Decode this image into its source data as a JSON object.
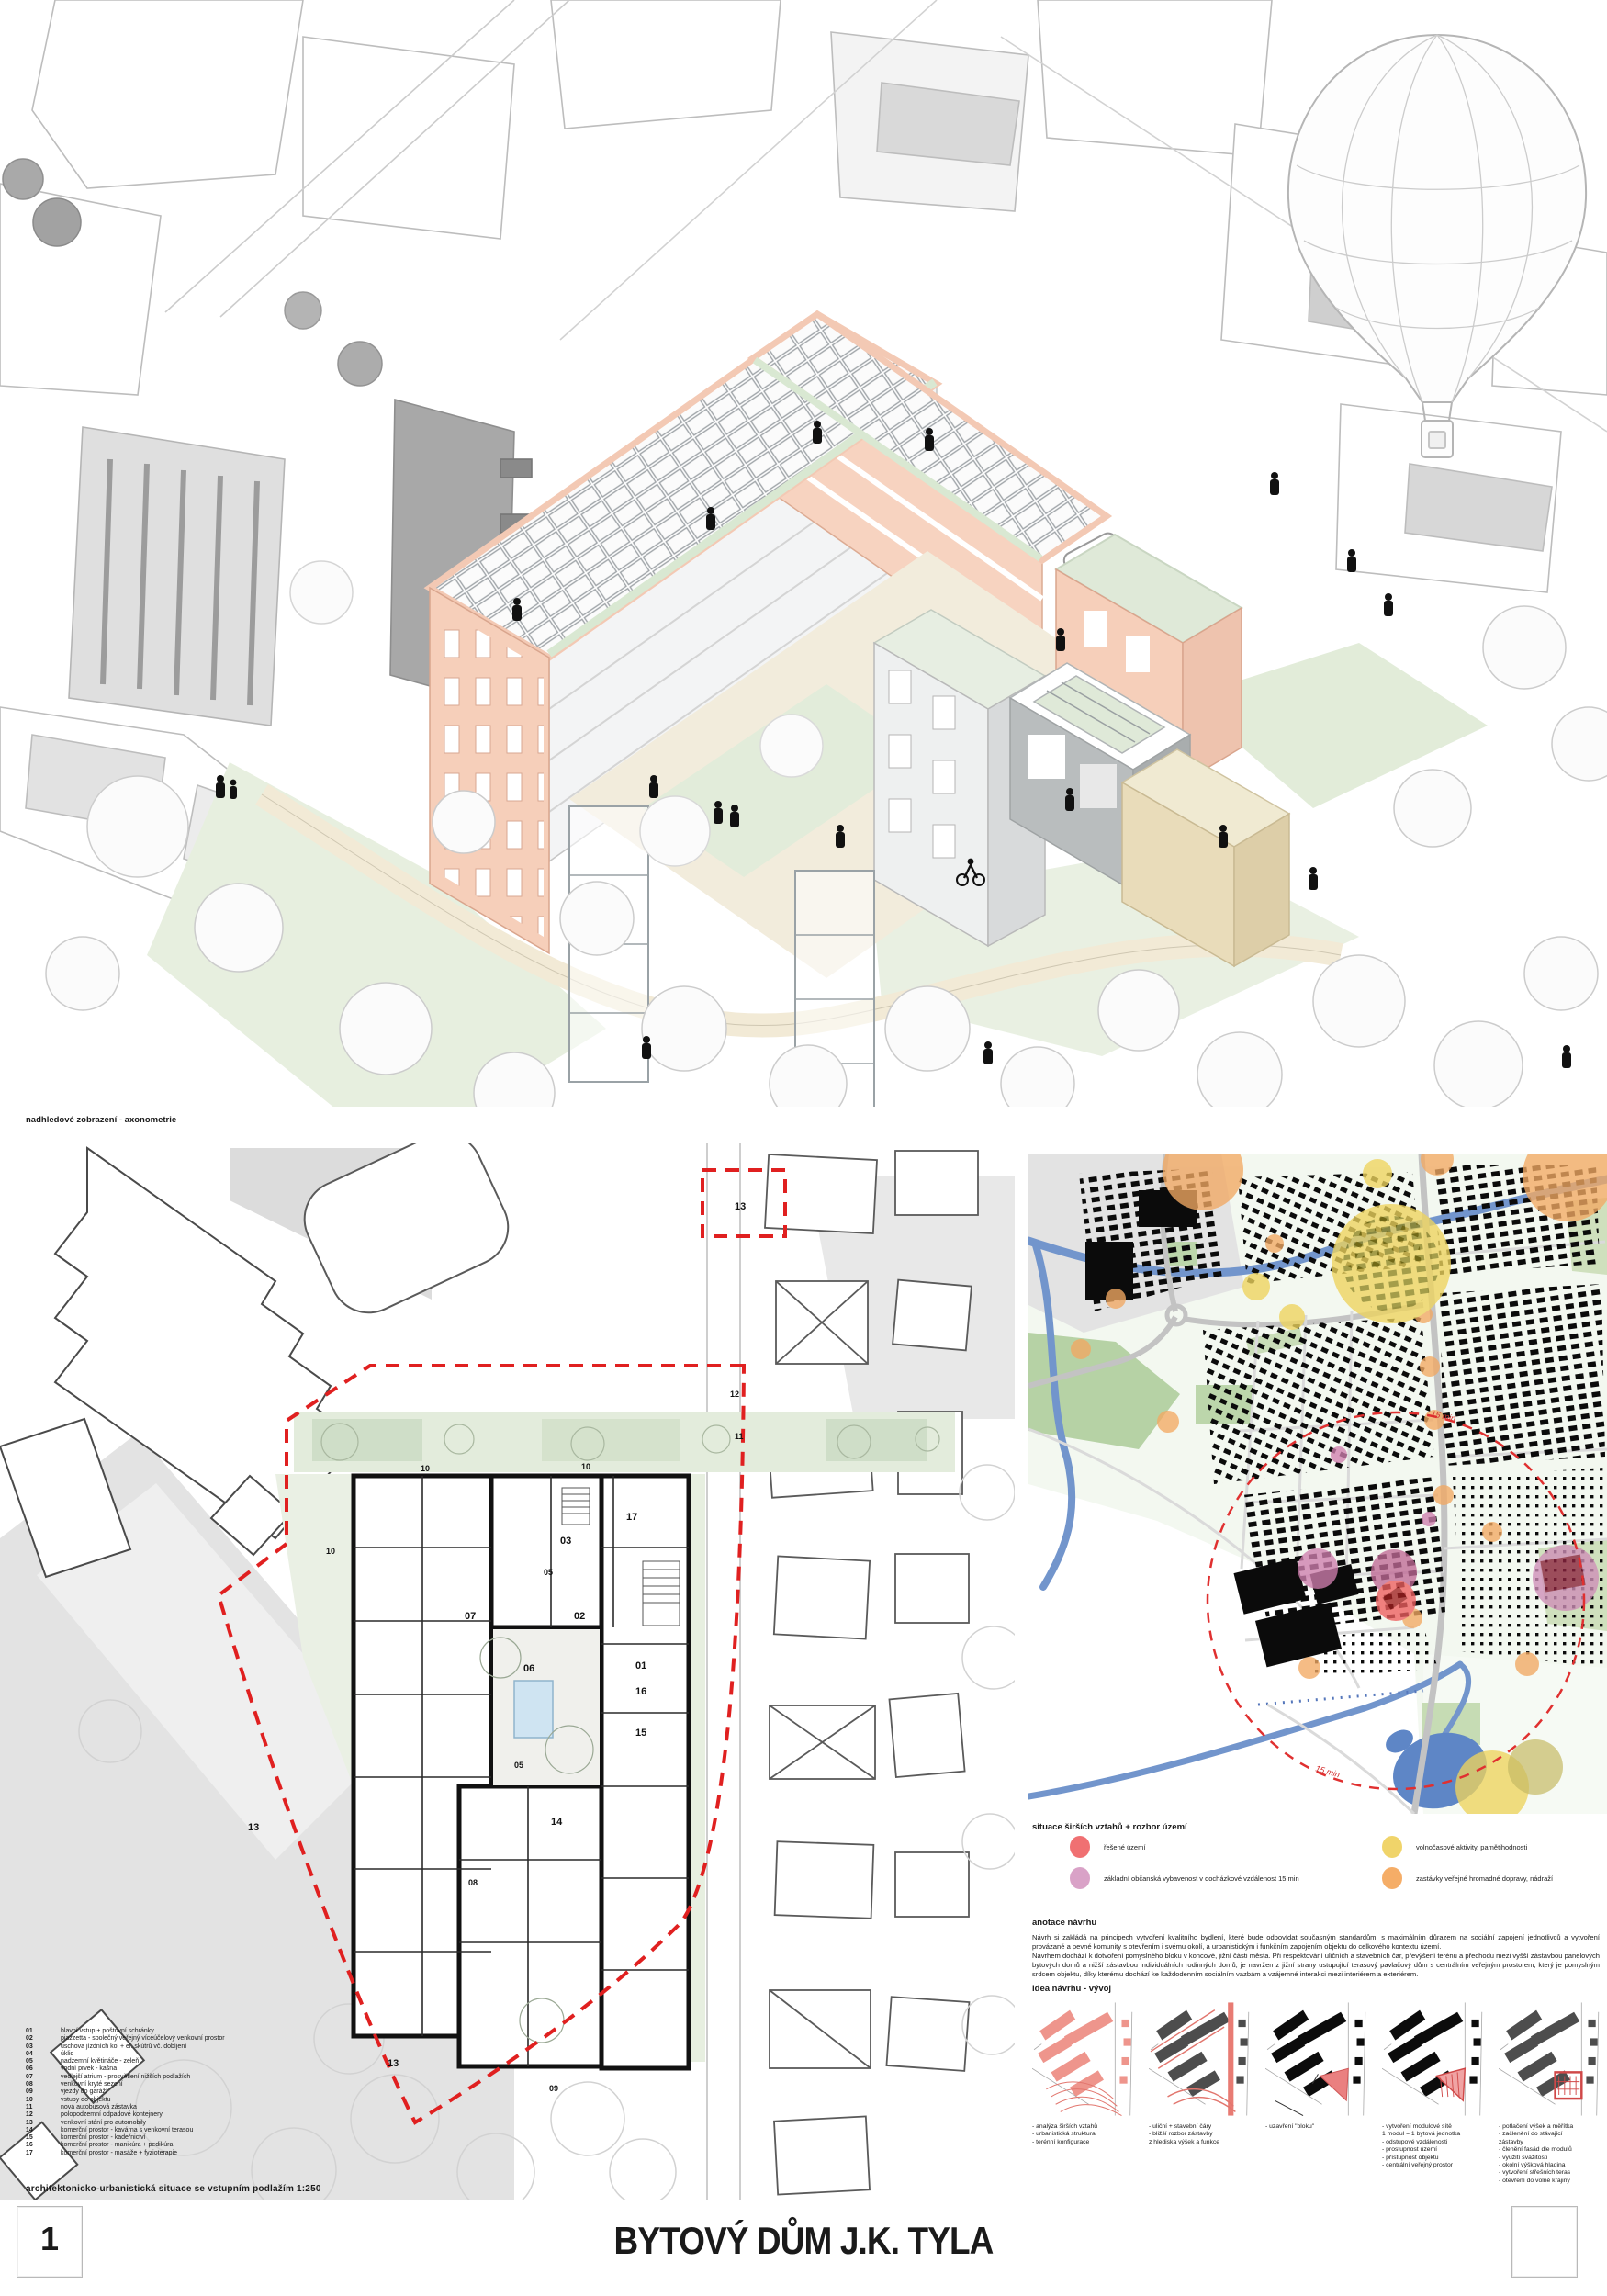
{
  "poster": {
    "sheet_number": "1",
    "title": "BYTOVÝ DŮM J.K. TYLA"
  },
  "axon": {
    "caption": "nadhledové zobrazení - axonometrie"
  },
  "site_plan": {
    "caption": "architektonicko-urbanistická situace se vstupním podlažím 1:250",
    "legend": [
      {
        "num": "01",
        "label": "hlavní vstup + poštovní schránky"
      },
      {
        "num": "02",
        "label": "piazzetta - společný veřejný víceúčelový venkovní prostor"
      },
      {
        "num": "03",
        "label": "úschova jízdních kol +  el. skútrů vč. dobíjení"
      },
      {
        "num": "04",
        "label": "úklid"
      },
      {
        "num": "05",
        "label": "nadzemní květináče - zeleň"
      },
      {
        "num": "06",
        "label": "vodní prvek - kašna"
      },
      {
        "num": "07",
        "label": "vedlejší atrium - prosvětlení nižších podlažích"
      },
      {
        "num": "08",
        "label": "venkovní kryté sezení"
      },
      {
        "num": "09",
        "label": "vjezdy do garáží"
      },
      {
        "num": "10",
        "label": "vstupy do objektu"
      },
      {
        "num": "11",
        "label": "nová autobusová zástavka"
      },
      {
        "num": "12",
        "label": "polopodzemní odpadové kontejnery"
      },
      {
        "num": "13",
        "label": "venkovní stání pro automobily"
      },
      {
        "num": "14",
        "label": "komerční prostor - kavárna s venkovní terasou"
      },
      {
        "num": "15",
        "label": "komerční prostor - kadeřnictví"
      },
      {
        "num": "16",
        "label": "komerční prostor - manikúra + pedikúra"
      },
      {
        "num": "17",
        "label": "komerční prostor - masáže + fyzioterapie"
      }
    ],
    "marks": [
      {
        "t": "13"
      },
      {
        "t": "10"
      },
      {
        "t": "10"
      },
      {
        "t": "10"
      },
      {
        "t": "03"
      },
      {
        "t": "17"
      },
      {
        "t": "05"
      },
      {
        "t": "07"
      },
      {
        "t": "06"
      },
      {
        "t": "02"
      },
      {
        "t": "01"
      },
      {
        "t": "16"
      },
      {
        "t": "15"
      },
      {
        "t": "14"
      },
      {
        "t": "13"
      },
      {
        "t": "13"
      },
      {
        "t": "05"
      },
      {
        "t": "12"
      },
      {
        "t": "11"
      },
      {
        "t": "09"
      },
      {
        "t": "08"
      }
    ]
  },
  "map": {
    "caption": "situace širších vztahů + rozbor území",
    "radius_label": "15 min",
    "legend": [
      {
        "label": "řešené území",
        "color": "#f07072"
      },
      {
        "label": "základní občanská vybavenost v docházkové vzdálenost 15 min",
        "color": "#d9a2c7"
      },
      {
        "label": "volnočasové aktivity, pamětihodnosti",
        "color": "#f0d46a"
      },
      {
        "label": "zastávky veřejné hromadné dopravy, nádraží",
        "color": "#f5ad67"
      }
    ]
  },
  "annotation": {
    "heading": "anotace návrhu",
    "para1": "Návrh si zakládá na principech vytvoření kvalitního bydlení, které bude odpovídat současným standardům, s maximálním důrazem na sociální zapojení jednotlivců a vytvoření provázané a pevné komunity s otevřením i svému okolí, a urbanistickým i funkčním zapojením objektu do celkového kontextu území.",
    "para2": "Návrhem dochází k dotvoření pomyslného bloku v koncové, jižní části města. Při respektování uličních a stavebních čar, převýšení terénu a přechodu mezi vyšší zástavbou panelových bytových domů a nižší zástavbou individuálních rodinných domů, je navržen z jižní strany ustupující terasový pavlačový dům s centrálním veřejným prostorem, který je pomyslným srdcem objektu, díky kterému dochází ke každodenním sociálním vazbám a vzájemné interakci mezi interiérem a exteriérem."
  },
  "idea": {
    "heading": "idea návrhu - vývoj",
    "steps": [
      {
        "caption": "- analýza širších vztahů\n- urbanistická struktura\n- terénní konfigurace"
      },
      {
        "caption": "- uliční + stavební čáry\n- bližší rozbor zástavby\nz hlediska výšek a funkce"
      },
      {
        "caption": "- uzavření \"bloku\""
      },
      {
        "caption": "- vytvoření modulové sítě\n1 modul = 1 bytová jednotka\n- odstupové vzdálenosti\n- prostupnost území\n- přístupnost objektu\n- centrální veřejný prostor"
      },
      {
        "caption": "- potlačení výšek a měřítka\n- začlenění do stávající\nzástavby\n- členění fasád dle modulů\n- využití svažitosti\n- okolní výšková hladina\n- vytvoření střešních teras\n- otevření do volné krajiny"
      }
    ]
  },
  "colors": {
    "facade_salmon": "#f6cfba",
    "facade_tan": "#e9dcba",
    "green_roof": "#dfe9d8",
    "boundary_red": "#e02020",
    "river_blue": "#7295cc"
  }
}
